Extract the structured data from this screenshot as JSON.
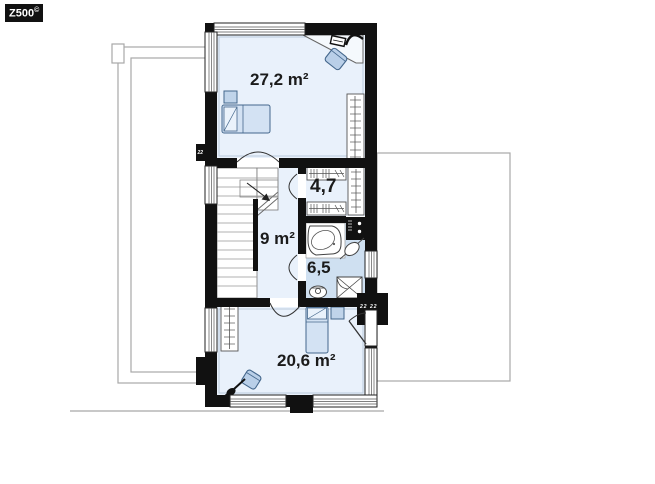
{
  "watermark": {
    "brand": "Z500",
    "symbol": "©"
  },
  "plan": {
    "type": "floor-plan",
    "rooms": [
      {
        "name": "bedroom-upper",
        "area": "27,2 m²"
      },
      {
        "name": "wardrobe-room",
        "area": "4,7"
      },
      {
        "name": "hallway-stairs",
        "area": "9 m²"
      },
      {
        "name": "bathroom",
        "area": "6,5"
      },
      {
        "name": "bedroom-lower",
        "area": "20,6 m²"
      }
    ],
    "vents": {
      "left": "22",
      "right": "22  22"
    },
    "colors": {
      "wall": "#111111",
      "room_fill": "#e9f1fb",
      "bathroom_fill": "#cfe0f1",
      "furniture_fill": "#c0d4ea",
      "furniture_stroke": "#44678c",
      "outline_gray": "#a8a8a8"
    }
  }
}
